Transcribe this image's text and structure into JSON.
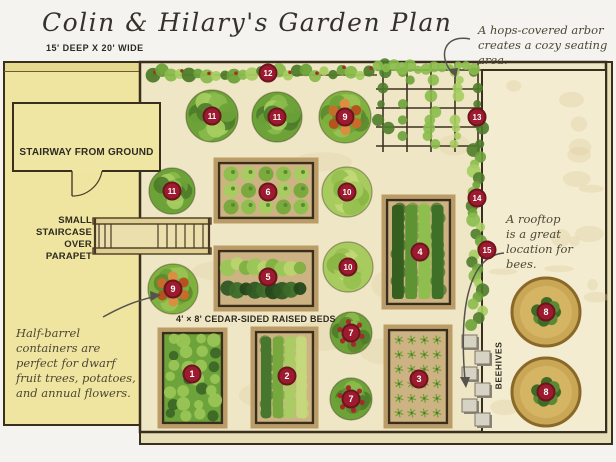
{
  "header": {
    "title": "Colin & Hilary's Garden Plan",
    "dimensions": "15' DEEP X 20' WIDE"
  },
  "annotations": {
    "arbor": {
      "text": "A hops-covered arbor\ncreates a cozy seating area."
    },
    "half_barrel": {
      "text": "Half-barrel\ncontainers are\nperfect for dwarf\nfruit trees, potatoes,\nand annual flowers."
    },
    "rooftop": {
      "text": "A rooftop\nis a great\nlocation for\nbees."
    }
  },
  "labels": {
    "stairway": "STAIRWAY FROM GROUND",
    "staircase": "SMALL\nSTAIRCASE\nOVER\nPARAPET",
    "raised_beds": "4' × 8' CEDAR-SIDED RAISED BEDS",
    "beehives": "BEEHIVES"
  },
  "colors": {
    "marker_red": "#9c1b2e",
    "marker_ring": "#701320",
    "roof_yellow": "#efe5a0",
    "garden_cream": "#eee6c4",
    "panel_cream": "#f3ecd0",
    "parapet": "#e7dfb8",
    "bed_tan": "#cdb384",
    "line_dark": "#3a2f1c",
    "wood": "#bb9c66"
  },
  "plan": {
    "markers": [
      {
        "n": "1",
        "x": 192,
        "y": 374
      },
      {
        "n": "2",
        "x": 287,
        "y": 376
      },
      {
        "n": "3",
        "x": 419,
        "y": 379
      },
      {
        "n": "4",
        "x": 420,
        "y": 252
      },
      {
        "n": "5",
        "x": 268,
        "y": 277
      },
      {
        "n": "6",
        "x": 268,
        "y": 192
      },
      {
        "n": "7",
        "x": 351,
        "y": 333
      },
      {
        "n": "7",
        "x": 351,
        "y": 399
      },
      {
        "n": "8",
        "x": 546,
        "y": 312
      },
      {
        "n": "8",
        "x": 546,
        "y": 392
      },
      {
        "n": "9",
        "x": 345,
        "y": 117
      },
      {
        "n": "9",
        "x": 173,
        "y": 289
      },
      {
        "n": "10",
        "x": 347,
        "y": 192
      },
      {
        "n": "10",
        "x": 348,
        "y": 267
      },
      {
        "n": "11",
        "x": 212,
        "y": 116
      },
      {
        "n": "11",
        "x": 277,
        "y": 117
      },
      {
        "n": "11",
        "x": 172,
        "y": 191
      },
      {
        "n": "12",
        "x": 268,
        "y": 73
      },
      {
        "n": "13",
        "x": 477,
        "y": 117
      },
      {
        "n": "14",
        "x": 477,
        "y": 198
      },
      {
        "n": "15",
        "x": 487,
        "y": 250
      }
    ],
    "beds": [
      {
        "id": "bed-1",
        "x": 163,
        "y": 333,
        "w": 59,
        "h": 90,
        "style": "leafy"
      },
      {
        "id": "bed-2",
        "x": 256,
        "y": 332,
        "w": 57,
        "h": 91,
        "style": "rows-light"
      },
      {
        "id": "bed-3",
        "x": 389,
        "y": 330,
        "w": 58,
        "h": 93,
        "style": "stars"
      },
      {
        "id": "bed-4",
        "x": 387,
        "y": 200,
        "w": 63,
        "h": 104,
        "style": "rows-dark"
      },
      {
        "id": "bed-5",
        "x": 219,
        "y": 251,
        "w": 94,
        "h": 55,
        "style": "two-band"
      },
      {
        "id": "bed-6",
        "x": 219,
        "y": 163,
        "w": 94,
        "h": 55,
        "style": "lettuce"
      }
    ],
    "containers": [
      {
        "x": 212,
        "y": 116,
        "r": 26,
        "type": "leafy"
      },
      {
        "x": 277,
        "y": 117,
        "r": 25,
        "type": "leafy"
      },
      {
        "x": 345,
        "y": 117,
        "r": 26,
        "type": "barrel"
      },
      {
        "x": 172,
        "y": 191,
        "r": 23,
        "type": "leafy"
      },
      {
        "x": 347,
        "y": 192,
        "r": 25,
        "type": "lettuce"
      },
      {
        "x": 348,
        "y": 267,
        "r": 25,
        "type": "lettuce"
      },
      {
        "x": 173,
        "y": 289,
        "r": 25,
        "type": "barrel"
      },
      {
        "x": 351,
        "y": 333,
        "r": 21,
        "type": "flower"
      },
      {
        "x": 351,
        "y": 399,
        "r": 21,
        "type": "flower"
      },
      {
        "x": 546,
        "y": 312,
        "r": 34,
        "type": "pot"
      },
      {
        "x": 546,
        "y": 392,
        "r": 34,
        "type": "pot"
      }
    ],
    "beehive_boxes": [
      {
        "x": 462,
        "y": 335
      },
      {
        "x": 475,
        "y": 351
      },
      {
        "x": 462,
        "y": 367
      },
      {
        "x": 475,
        "y": 383
      },
      {
        "x": 462,
        "y": 399
      },
      {
        "x": 475,
        "y": 413
      }
    ],
    "hedge": {
      "x1": 153,
      "x2": 377,
      "y": 73
    },
    "trellis": {
      "hy": [
        70,
        89,
        108,
        127,
        146
      ],
      "vx": [
        383,
        407,
        431,
        455,
        478
      ],
      "x1": 376,
      "x2": 481,
      "y1": 63,
      "y2": 152
    }
  }
}
